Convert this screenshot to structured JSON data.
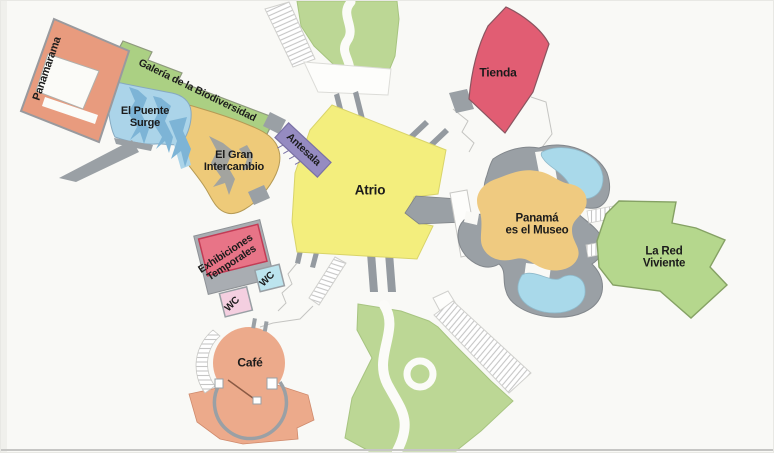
{
  "map": {
    "palette": {
      "background": "#f9f9f6",
      "garden": "#bcd795",
      "water": "#a9d9ea",
      "structure_gray": "#9aa0a5",
      "walkway_gray": "#949aa0",
      "hatch_line": "#c6c6c6",
      "bottom_border": "#c6c6c4"
    },
    "regions": [
      {
        "name": "panamarama",
        "label": "Panamarama",
        "color": "#e89b7e"
      },
      {
        "name": "galeria-biodiversidad",
        "label": "Galería de la Biodiversidad",
        "color": "#abd083"
      },
      {
        "name": "el-puente-surge",
        "label": "El Puente\nSurge",
        "color": "#abd4e9"
      },
      {
        "name": "el-gran-intercambio",
        "label": "El Gran\nIntercambio",
        "color": "#eeca79"
      },
      {
        "name": "antesala",
        "label": "Antesala",
        "color": "#958bc1"
      },
      {
        "name": "atrio",
        "label": "Atrio",
        "color": "#f3ee7d"
      },
      {
        "name": "tienda",
        "label": "Tienda",
        "color": "#e15d73"
      },
      {
        "name": "panama-es-el-museo",
        "label": "Panamá\nes el Museo",
        "color": "#efca80"
      },
      {
        "name": "la-red-viviente",
        "label": "La Red\nViviente",
        "color": "#b5d78d"
      },
      {
        "name": "exhibiciones-temporales",
        "label": "Exhibiciones\nTemporales",
        "color": "#e87487"
      },
      {
        "name": "wc-pink",
        "label": "WC",
        "color": "#f4cfe0"
      },
      {
        "name": "wc-blue",
        "label": "WC",
        "color": "#bce4ee"
      },
      {
        "name": "cafe",
        "label": "Café",
        "color": "#ecaa8b"
      }
    ]
  }
}
